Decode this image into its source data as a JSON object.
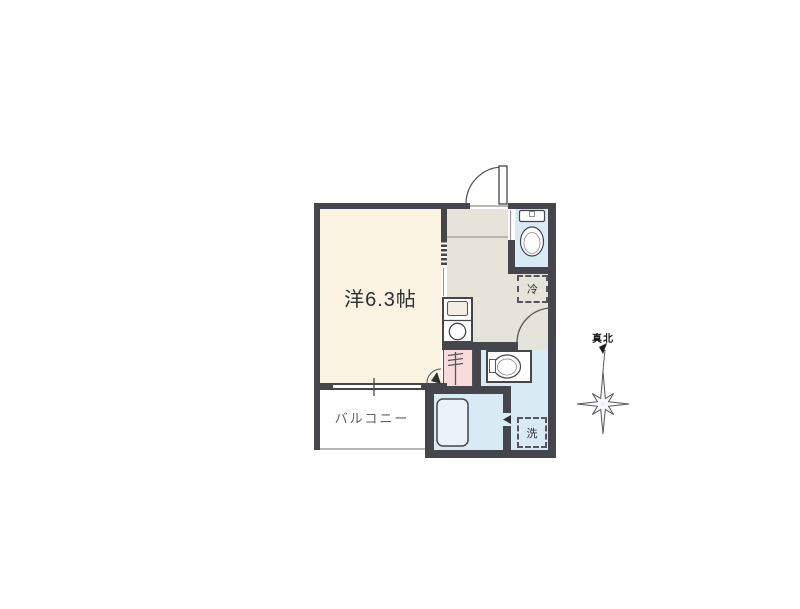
{
  "plan": {
    "type": "apartment-floor-plan",
    "rooms": {
      "main_room_label": "洋6.3帖",
      "balcony_label": "バルコニー",
      "refrigerator_label": "冷",
      "washer_label": "洗"
    },
    "compass": {
      "north_label": "真北"
    },
    "colors": {
      "wall": "#45464c",
      "main_room_fill": "#faf3e1",
      "hallway_fill": "#e4e4da",
      "wet_area_fill": "#d8eaf3",
      "utility_fill": "#f8dcdc",
      "balcony_fill": "#ffffff"
    },
    "icons": {
      "entrance": "entrance-door-icon",
      "toilet": "toilet-icon",
      "kitchen": "kitchen-sink-and-burner-icon",
      "washbasin": "washbasin-icon",
      "bathtub": "bathtub-icon",
      "compass": "compass-rose-icon"
    }
  }
}
